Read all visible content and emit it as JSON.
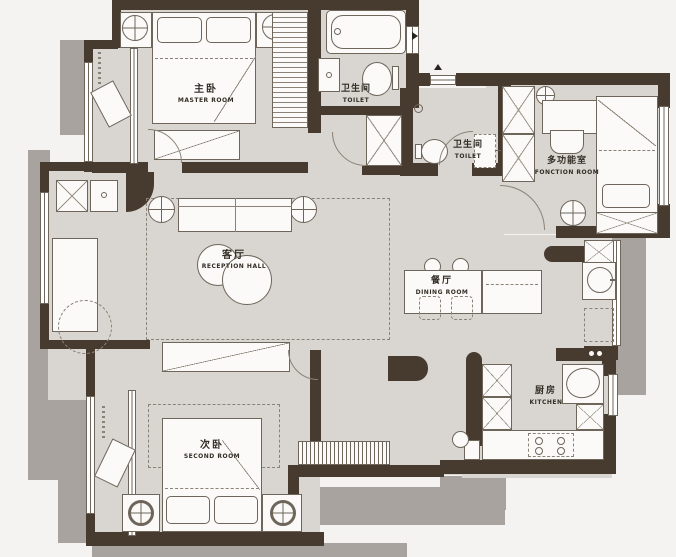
{
  "plan_title": "apartment-floor-plan",
  "rooms": {
    "master": {
      "zh": "主卧",
      "en": "MASTER ROOM"
    },
    "bath": {
      "zh": "卫生间",
      "en": "TOILET"
    },
    "toilet": {
      "zh": "卫生间",
      "en": "TOILET"
    },
    "function": {
      "zh": "多功能室",
      "en": "FONCTION ROOM"
    },
    "reception": {
      "zh": "客厅",
      "en": "RECEPTION HALL"
    },
    "dining": {
      "zh": "餐厅",
      "en": "DINING ROOM"
    },
    "kitchen": {
      "zh": "厨房",
      "en": "KITCHEN"
    },
    "second": {
      "zh": "次卧",
      "en": "SECOND ROOM"
    }
  },
  "colors": {
    "wall": "#473b30",
    "floor": "#d9d5d0",
    "shadow": "#a8a39e",
    "paper": "#f4f3f1",
    "furniture": "#fbfaf8",
    "line": "#6e655b",
    "text": "#332d26"
  }
}
